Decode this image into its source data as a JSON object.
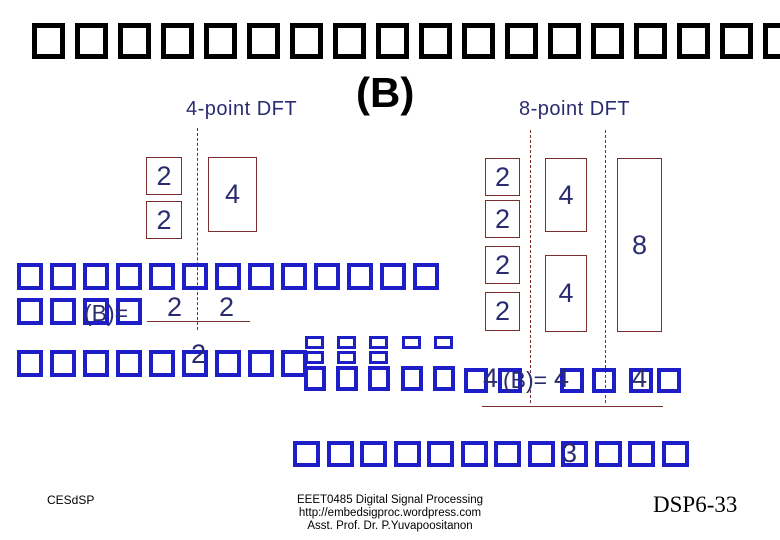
{
  "title": {
    "tofu_count": 18
  },
  "heading": {
    "variant_label": "(B)",
    "left_dft_label": "4-point DFT",
    "right_dft_label": "8-point DFT"
  },
  "left_diagram": {
    "stage1_values": [
      "2",
      "2"
    ],
    "stage2_value": "4"
  },
  "right_diagram": {
    "stage1_values": [
      "2",
      "2",
      "2",
      "2"
    ],
    "stage2_values": [
      "4",
      "4"
    ],
    "stage3_value": "8"
  },
  "paragraph1": {
    "line1_tofu_count": 13,
    "line2_tofu_count": 4,
    "line2_label": "(B)=",
    "line3_tofu_count": 9,
    "fraction": {
      "numerator_left": "2",
      "numerator_right": "2",
      "denominator": "2"
    }
  },
  "paragraph2": {
    "marked2_tofu_count": 3,
    "marked1_tofu_count": 2,
    "plain_tofu_count": 1,
    "trailing_tofu_count": 5,
    "inline_text": {
      "t1": "4",
      "t2": "(B)=",
      "t3": "4",
      "t4": "4"
    }
  },
  "bottom_line": {
    "tofu_count": 12,
    "number": "3"
  },
  "footer": {
    "left": "CESdSP",
    "center_lines": [
      "EEET0485 Digital Signal Processing",
      "http://embedsigproc.wordpress.com",
      "Asst. Prof. Dr. P.Yuvapoositanon"
    ],
    "right": "DSP6-33"
  },
  "colors": {
    "ink": "#000000",
    "tofu_blue": "#1e1ec8",
    "navy_text": "#2b2b70",
    "maroon": "#7a2e2e"
  }
}
